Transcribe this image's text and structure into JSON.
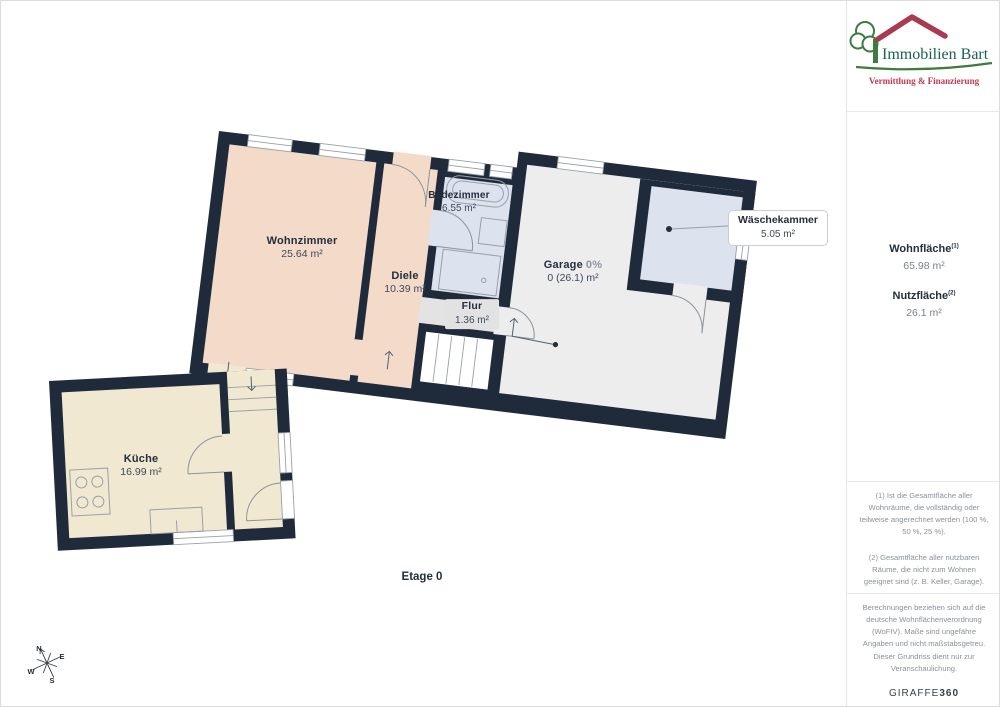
{
  "logo": {
    "title": "Immobilien Bart",
    "subtitle": "Vermittlung & Finanzierung",
    "colors": {
      "tree": "#3e7c3e",
      "roof": "#a93a52",
      "title": "#1b5f58",
      "subtitle": "#c23a50"
    }
  },
  "sidebar": {
    "area_summary": [
      {
        "label": "Wohnfläche",
        "sup": "(1)",
        "value": "65.98 m²"
      },
      {
        "label": "Nutzfläche",
        "sup": "(2)",
        "value": "26.1 m²"
      }
    ],
    "footnotes": [
      "(1) Ist die Gesamtfläche aller Wohnräume, die vollständig oder teilweise angerechnet werden (100 %, 50 %, 25 %).",
      "(2) Gesamtfläche aller nutzbaren Räume, die nicht zum Wohnen geeignet sind (z. B. Keller, Garage)."
    ],
    "disclaimer": "Berechnungen beziehen sich auf die deutsche Wohnflächenverordnung (WoFIV). Maße sind ungefähre Angaben und nicht maßstabsgetreu. Dieser Grundriss dient nur zur Veranschaulichung.",
    "brand_name": "GIRAFFE",
    "brand_suffix": "360"
  },
  "floorplan": {
    "floor_label": "Etage 0",
    "rooms": [
      {
        "id": "wohnzimmer",
        "name": "Wohnzimmer",
        "area": "25.64 m²"
      },
      {
        "id": "diele",
        "name": "Diele",
        "area": "10.39 m²"
      },
      {
        "id": "badezimmer",
        "name": "Badezimmer",
        "area": "6.55 m²"
      },
      {
        "id": "flur",
        "name": "Flur",
        "area": "1.36 m²"
      },
      {
        "id": "garage",
        "name": "Garage",
        "percent": "0%",
        "area": "0 (26.1) m²"
      },
      {
        "id": "waeschekammer",
        "name": "Wäschekammer",
        "area": "5.05 m²"
      },
      {
        "id": "kueche",
        "name": "Küche",
        "area": "16.99 m²"
      }
    ],
    "compass": {
      "n": "N",
      "e": "E",
      "s": "S",
      "w": "W"
    },
    "colors": {
      "wall": "#1f2b3b",
      "living": "#f3dac9",
      "bath": "#dce2ee",
      "garage": "#ededed",
      "flur": "#e3e3e3",
      "kitchen": "#f1e8d1"
    }
  }
}
